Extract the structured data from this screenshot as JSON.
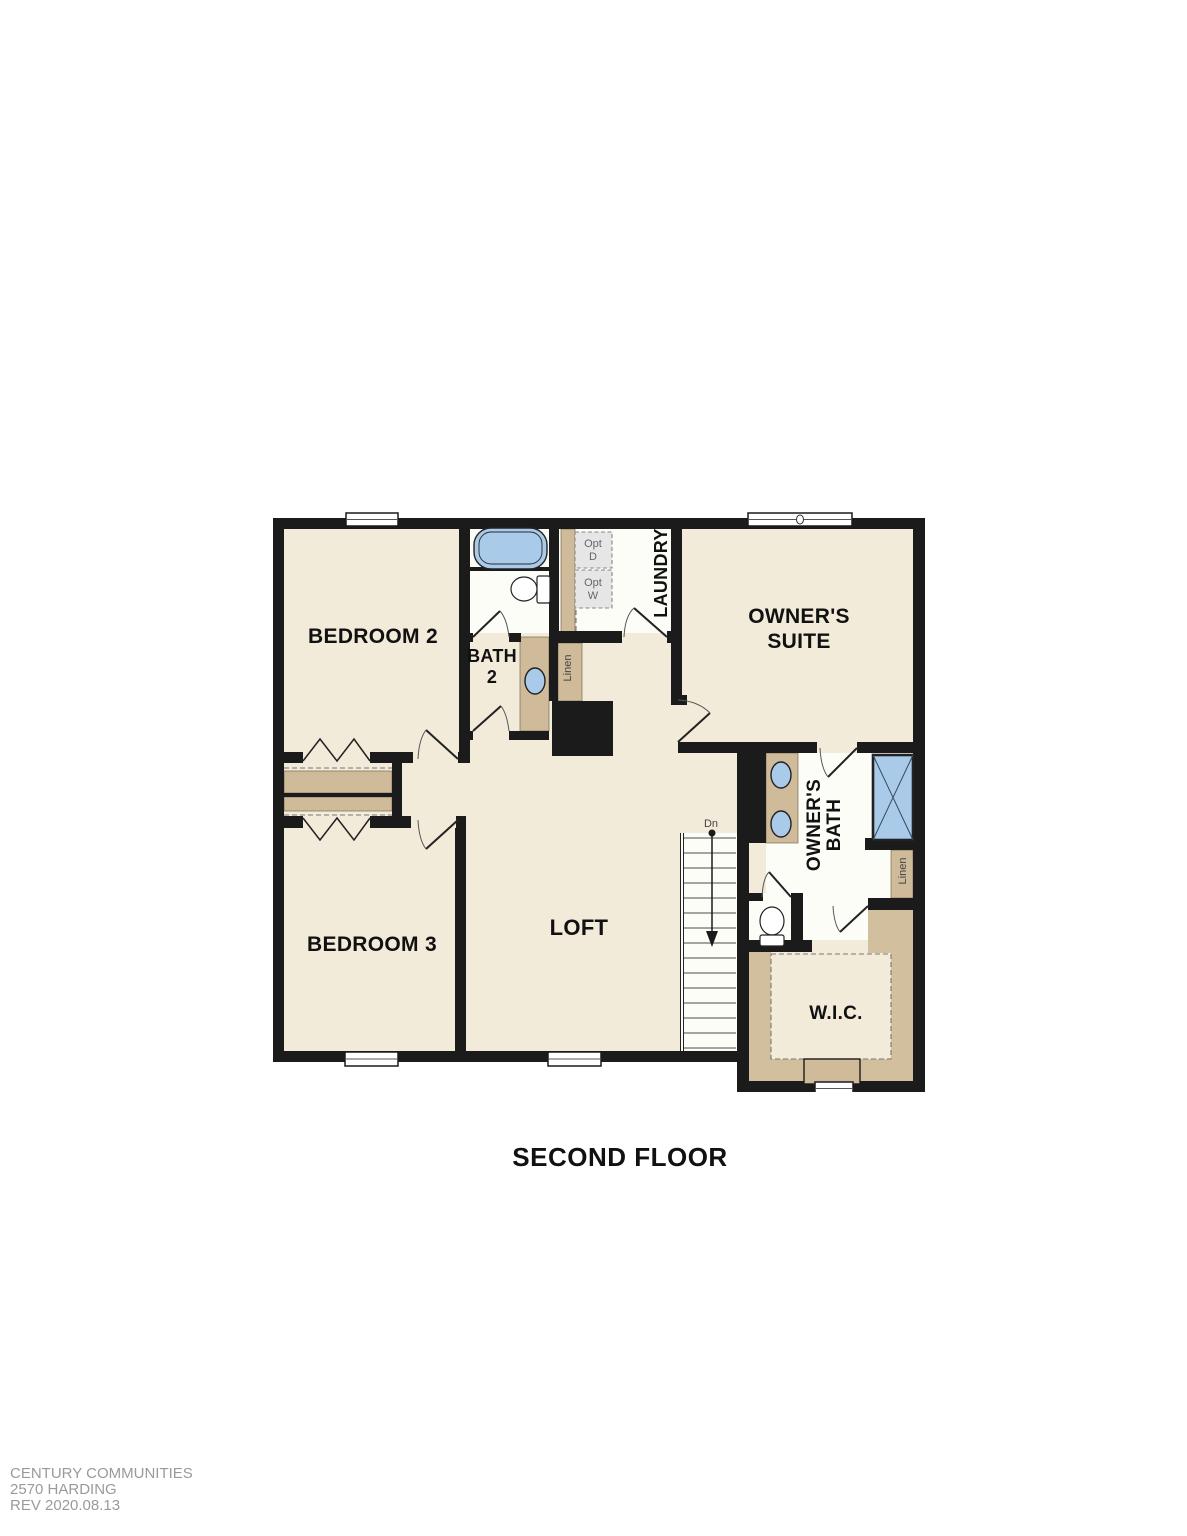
{
  "title": "SECOND FLOOR",
  "footer": {
    "brand": "CENTURY COMMUNITIES",
    "plan_name": "2570 HARDING",
    "revision": "REV 2020.08.13"
  },
  "rooms": {
    "bedroom2": {
      "label": "BEDROOM 2"
    },
    "bedroom3": {
      "label": "BEDROOM 3"
    },
    "bath2": {
      "line1": "BATH",
      "line2": "2"
    },
    "laundry": {
      "label": "LAUNDRY"
    },
    "owners_suite": {
      "line1": "OWNER'S",
      "line2": "SUITE"
    },
    "owners_bath": {
      "line1": "OWNER'S",
      "line2": "BATH"
    },
    "loft": {
      "label": "LOFT"
    },
    "wic": {
      "label": "W.I.C."
    }
  },
  "annotations": {
    "bath2_linen": "Linen",
    "owners_bath_linen": "Linen",
    "opt_dryer": {
      "line1": "Opt",
      "line2": "D"
    },
    "opt_washer": {
      "line1": "Opt",
      "line2": "W"
    },
    "stair_direction": "Dn"
  },
  "colors": {
    "wall": "#1b1b1b",
    "room": "#f2ebd9",
    "wet": "#fdfdf8",
    "tan": "#cfba99",
    "band": "#d2bf9e",
    "blue": "#a9cbe9",
    "optbox": "#e6e6e6",
    "gray_text": "#666666",
    "footer": "#9a9a9a",
    "label": "#111111",
    "arc": "#555555",
    "dash": "#777777"
  }
}
